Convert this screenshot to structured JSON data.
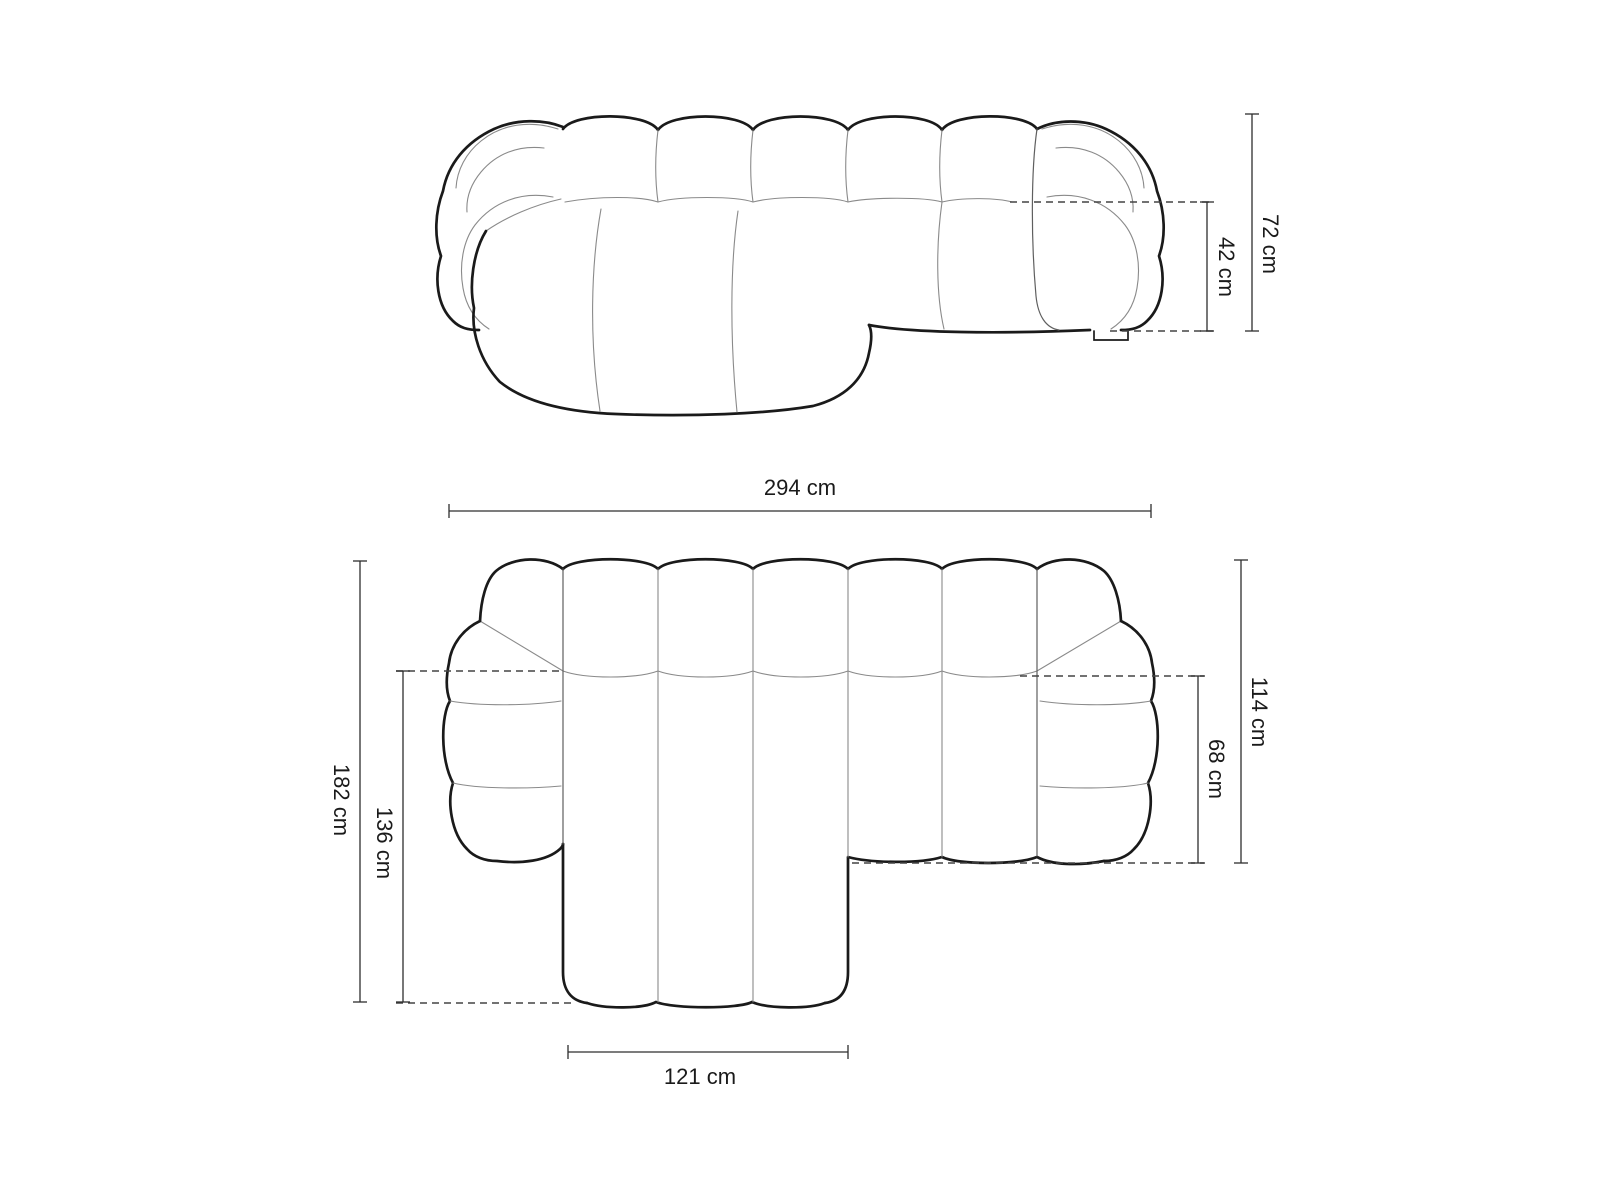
{
  "canvas": {
    "background": "#ffffff"
  },
  "palette": {
    "outline": "#1a1a1a",
    "seam": "#8a8a8a",
    "boundary": "#5f5f5f",
    "dimension_line": "#2e2e2e",
    "dashed_line": "#444444",
    "label_text": "#1a1a1a"
  },
  "labels": {
    "overall_height": "72 cm",
    "seat_height": "42 cm",
    "overall_width": "294 cm",
    "overall_depth": "182 cm",
    "chaise_depth": "136 cm",
    "body_depth": "114 cm",
    "seat_depth": "68 cm",
    "chaise_width": "121 cm"
  }
}
